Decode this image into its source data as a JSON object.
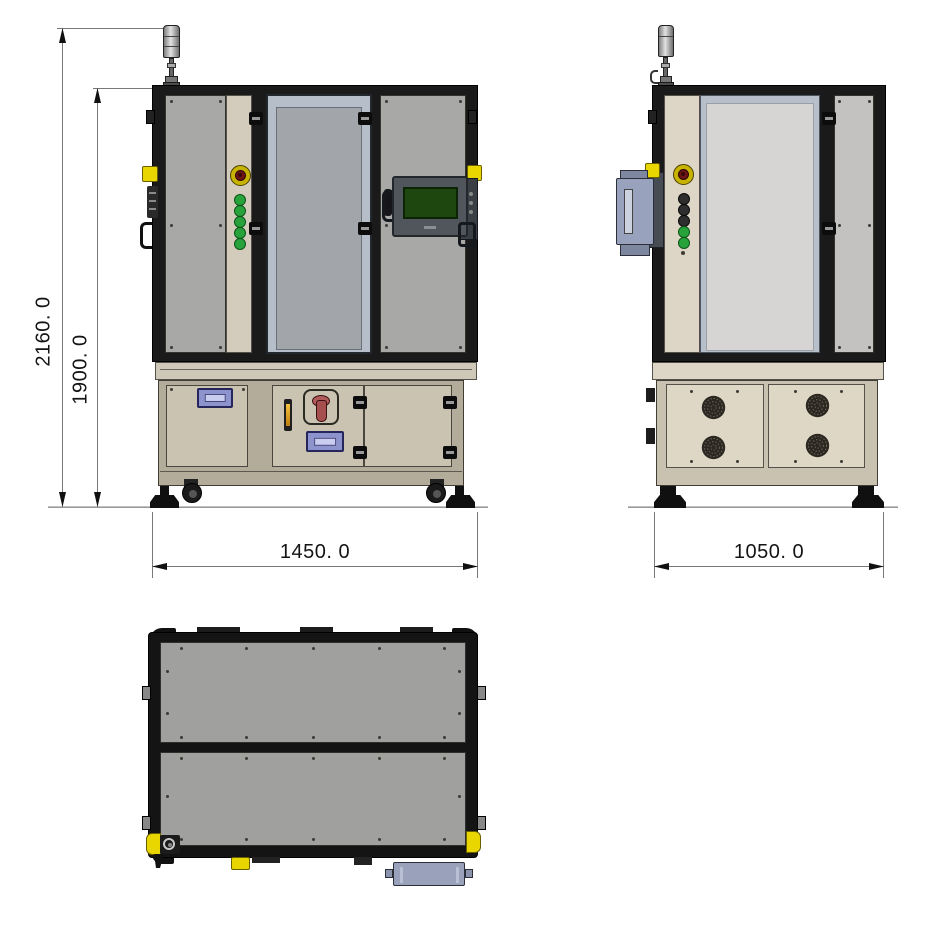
{
  "drawing": {
    "type": "three-view engineering drawing of an enclosed industrial machine",
    "dimensions": {
      "total_height": "2160. 0",
      "frame_height": "1900. 0",
      "front_width": "1450. 0",
      "side_depth": "1050. 0"
    },
    "components": {
      "signal_tower": "stack-light on mast (front & side views)",
      "emergency_stop": "red mushroom button with yellow collar",
      "front_indicator_buttons": 5,
      "side_indicator_buttons": 5,
      "hmi_display": "touch panel with dark green screen",
      "main_power_switch": "red rotary disconnect on lower center door",
      "sight_glass": "amber vertical indicator",
      "nameplates": 3,
      "cooling_fans": 4,
      "casters": 2,
      "leveling_feet": 4
    },
    "colors": {
      "frame_black": "#1a1a1a",
      "panel_gray": "#a8a8a6",
      "beige_strip": "#d3ccbd",
      "cabinet_beige": "#cac3b2",
      "fan_panel_beige": "#ded7c6",
      "glass_frame_blue": "#b5bec9",
      "side_window": "#d6d5d3",
      "hmi_screen_green": "#1d470f",
      "safety_yellow": "#e9d600",
      "estop_red": "#6e1414",
      "button_green": "#28a23a",
      "nameplate_lavender": "#8d93cc",
      "switch_red": "#b15b5b",
      "dimension_line": "#787878"
    }
  }
}
